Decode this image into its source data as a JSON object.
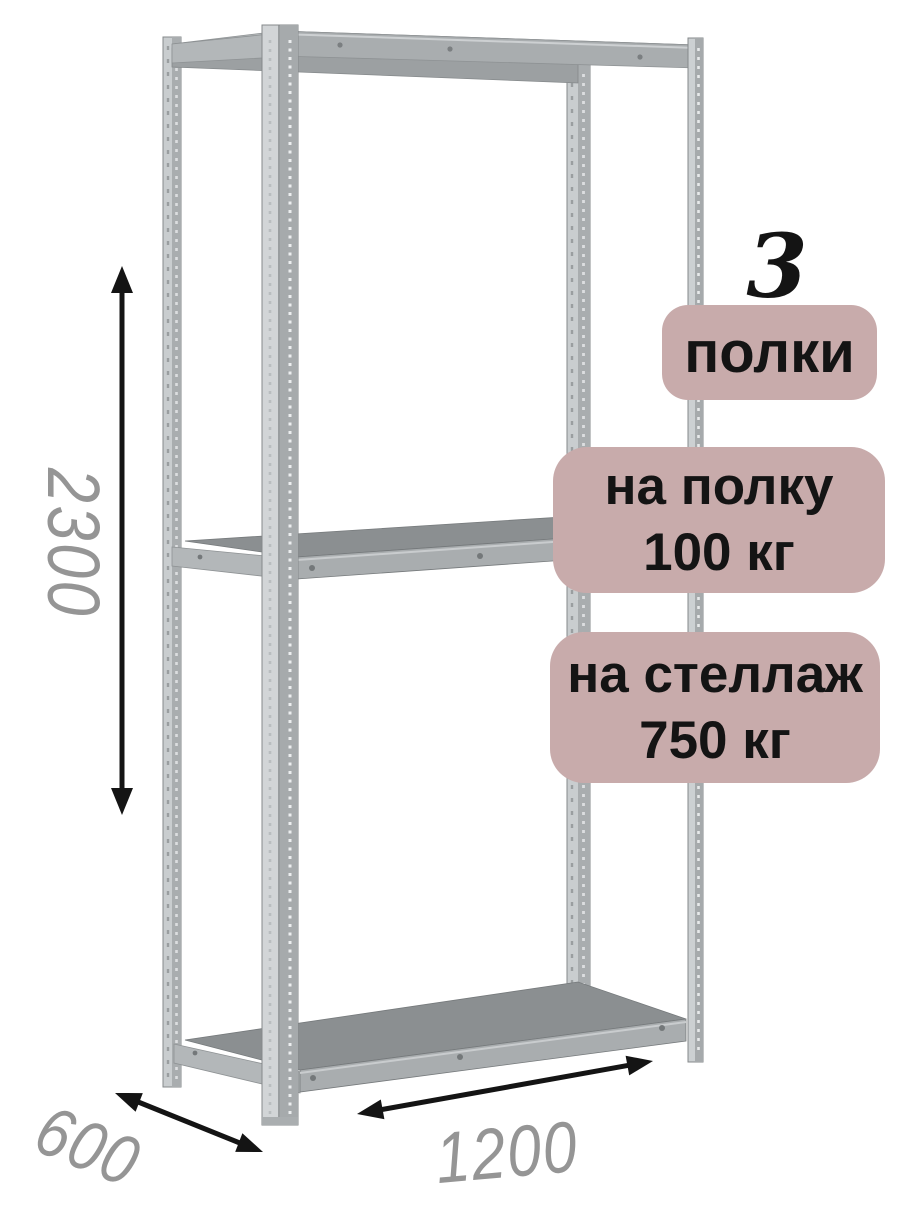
{
  "dimensions": {
    "height": "2300",
    "depth": "600",
    "width": "1200"
  },
  "callouts": {
    "shelf_count": {
      "value": "3",
      "label": "полки"
    },
    "per_shelf": {
      "line1": "на полку",
      "line2": "100 кг"
    },
    "per_rack": {
      "line1": "на стеллаж",
      "line2": "750 кг"
    }
  },
  "icons": [
    {
      "name": "double-arrow-vertical-icon",
      "meaning": "height dimension 2300"
    },
    {
      "name": "double-arrow-diagonal-icon",
      "meaning": "depth dimension 600"
    },
    {
      "name": "double-arrow-width-icon",
      "meaning": "width dimension 1200"
    }
  ],
  "colors": {
    "background": "#ffffff",
    "badge_background": "#c8abab",
    "badge_text": "#141414",
    "dimension_text": "#959595",
    "arrow": "#141414",
    "metal_light": "#d2d5d7",
    "metal_mid": "#a9adaf",
    "metal_dark": "#8b8f91",
    "metal_outline": "#85898b"
  }
}
